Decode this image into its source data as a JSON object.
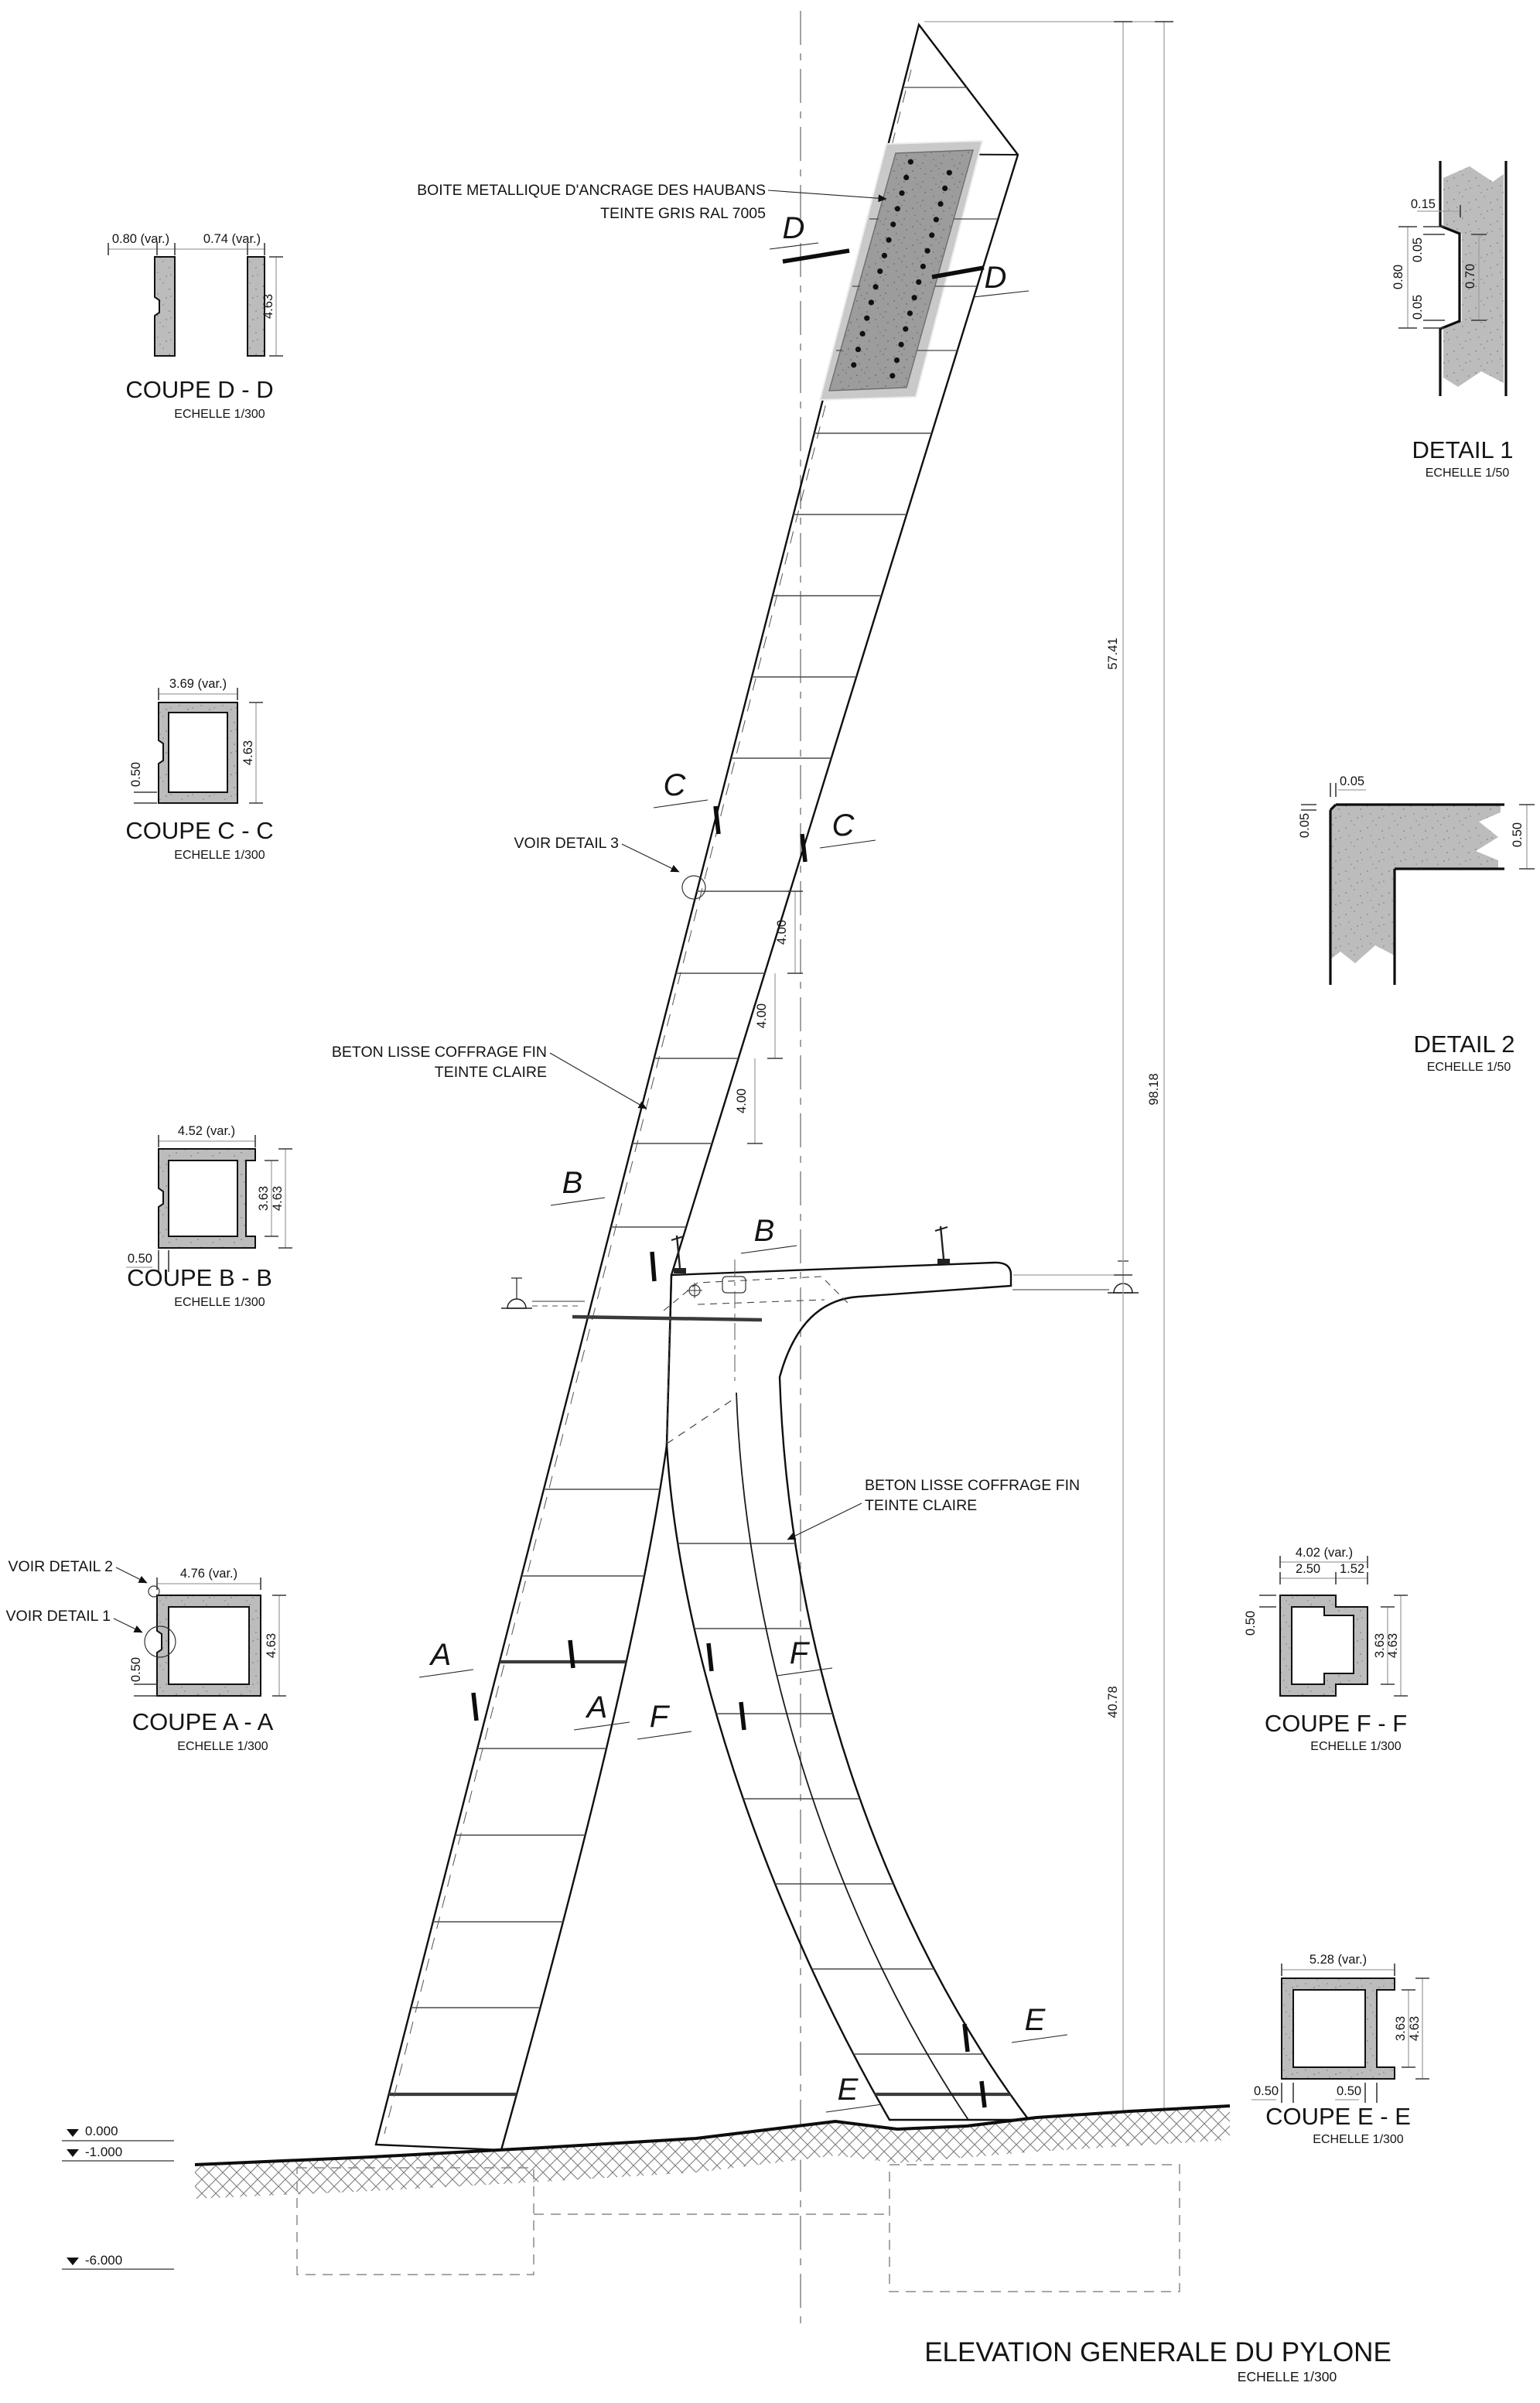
{
  "page": {
    "title": "ELEVATION GENERALE DU PYLONE",
    "scale": "ECHELLE 1/300"
  },
  "annotations": {
    "anchor_line1": "BOITE METALLIQUE D'ANCRAGE DES HAUBANS",
    "anchor_line2": "TEINTE GRIS  RAL 7005",
    "voir_detail_3": "VOIR DETAIL 3",
    "beton_line1": "BETON LISSE COFFRAGE FIN",
    "beton_line2": "TEINTE CLAIRE"
  },
  "levels": {
    "ground": "0.000",
    "minus1": "-1.000",
    "minus6": "-6.000"
  },
  "dims": {
    "h_top": "57.41",
    "h_total": "98.18",
    "h_bottom": "40.78",
    "segment": "4.00"
  },
  "letters": {
    "a": "A",
    "b": "B",
    "c": "C",
    "d": "D",
    "e": "E",
    "f": "F"
  },
  "sections": {
    "dd": {
      "title": "COUPE D - D",
      "scale": "ECHELLE 1/300",
      "w1": "0.80 (var.)",
      "w2": "0.74 (var.)",
      "h": "4.63"
    },
    "cc": {
      "title": "COUPE C - C",
      "scale": "ECHELLE 1/300",
      "w": "3.69 (var.)",
      "h": "4.63",
      "t": "0.50"
    },
    "bb": {
      "title": "COUPE B - B",
      "scale": "ECHELLE 1/300",
      "w": "4.52 (var.)",
      "hi": "3.63",
      "h": "4.63",
      "t": "0.50"
    },
    "aa": {
      "title": "COUPE A - A",
      "scale": "ECHELLE 1/300",
      "w": "4.76 (var.)",
      "h": "4.63",
      "t": "0.50",
      "note1": "VOIR DETAIL 1",
      "note2": "VOIR DETAIL 2"
    },
    "d1": {
      "title": "DETAIL 1",
      "scale": "ECHELLE 1/50",
      "a": "0.15",
      "b": "0.05",
      "c": "0.80",
      "d": "0.05",
      "e": "0.70"
    },
    "d2": {
      "title": "DETAIL 2",
      "scale": "ECHELLE 1/50",
      "a": "0.05",
      "b": "0.05",
      "c": "0.50"
    },
    "ff": {
      "title": "COUPE F - F",
      "scale": "ECHELLE 1/300",
      "w": "4.02 (var.)",
      "w1": "2.50",
      "w2": "1.52",
      "hi": "3.63",
      "h": "4.63",
      "t": "0.50"
    },
    "ee": {
      "title": "COUPE E - E",
      "scale": "ECHELLE 1/300",
      "w": "5.28 (var.)",
      "hi": "3.63",
      "h": "4.63",
      "t1": "0.50",
      "t2": "0.50"
    }
  },
  "colors": {
    "concrete": "#bcbcbc",
    "anchor_box": "#9c9c9c",
    "line": "#111111"
  }
}
